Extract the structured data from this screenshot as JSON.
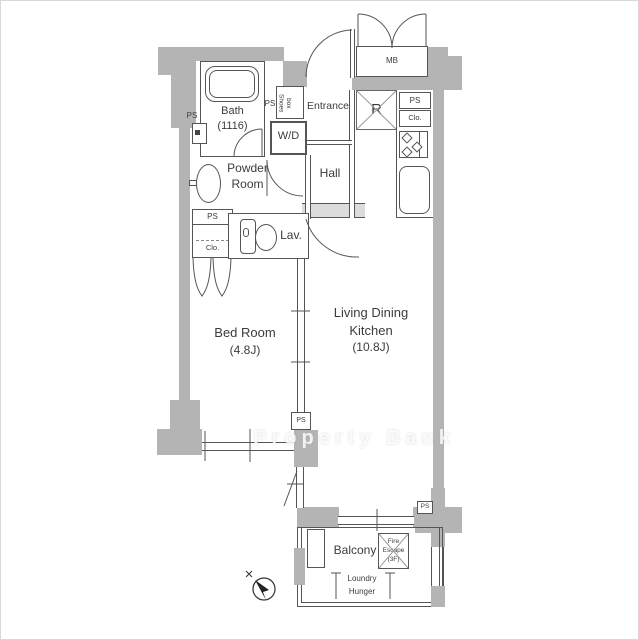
{
  "watermark": "Property Bank",
  "palette": {
    "wall": "#b4b4b4",
    "line": "#4f4f4f",
    "threshold": "#dcdcdc"
  },
  "rooms": {
    "bath": {
      "label": "Bath",
      "size": "(1116)"
    },
    "powder": {
      "line1": "Powder",
      "line2": "Room"
    },
    "entrance": {
      "label": "Entrance"
    },
    "hall": {
      "label": "Hall"
    },
    "wd": {
      "label": "W/D"
    },
    "lav": {
      "label": "Lav."
    },
    "bedroom": {
      "label": "Bed Room",
      "size": "(4.8J)"
    },
    "ldk": {
      "line1": "Living Dining",
      "line2": "Kitchen",
      "size": "(10.8J)"
    },
    "balcony": {
      "label": "Balcony"
    }
  },
  "fixtures": {
    "mb": "MB",
    "r": "R",
    "ps": "PS",
    "clo": "Clo.",
    "shoes": {
      "line1": "Shoes",
      "line2": "box"
    },
    "fire_escape": {
      "line1": "Fire",
      "line2": "Escape",
      "line3": "(3F)"
    },
    "laundry": {
      "line1": "Loundry",
      "line2": "Hunger"
    }
  }
}
